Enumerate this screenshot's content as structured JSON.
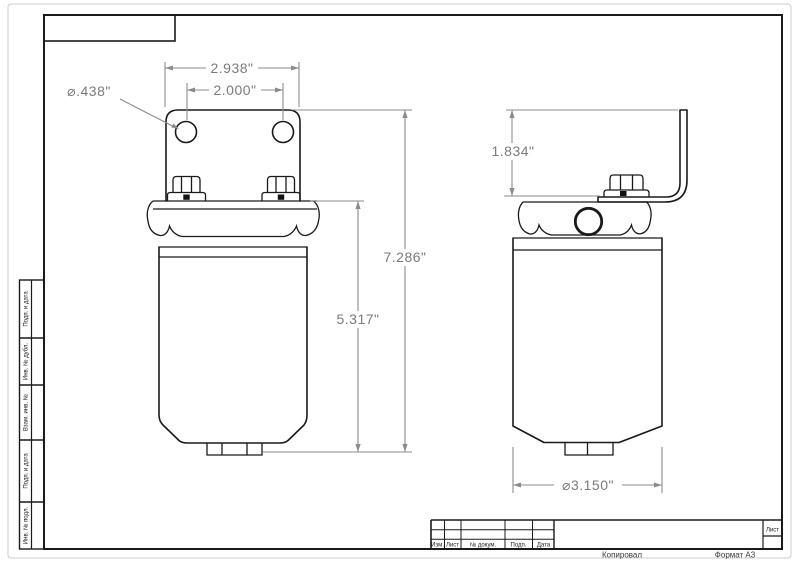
{
  "drawing": {
    "dimensions": {
      "bracket_width": "2.938\"",
      "hole_spacing": "2.000\"",
      "hole_diameter": "⌀.438\"",
      "overall_height": "7.286\"",
      "body_height": "5.317\"",
      "bracket_height": "1.834\"",
      "body_diameter": "⌀3.150\""
    },
    "colors": {
      "part_line": "#1a1a1a",
      "dimension_line": "#8b8b8b",
      "dimension_text": "#7b7b7b"
    }
  },
  "frame": {
    "side_column_labels": [
      "Подп. и дата",
      "Инв. № дубл.",
      "Взам. инв. №",
      "Подп. и дата",
      "Инв. № подл."
    ],
    "title_block": {
      "revision_columns": [
        "Изм.",
        "Лист",
        "№ докум.",
        "Подп.",
        "Дата"
      ],
      "sheet_label": "Лист",
      "footer_copied": "Копировал",
      "footer_format": "Формат А3"
    }
  }
}
